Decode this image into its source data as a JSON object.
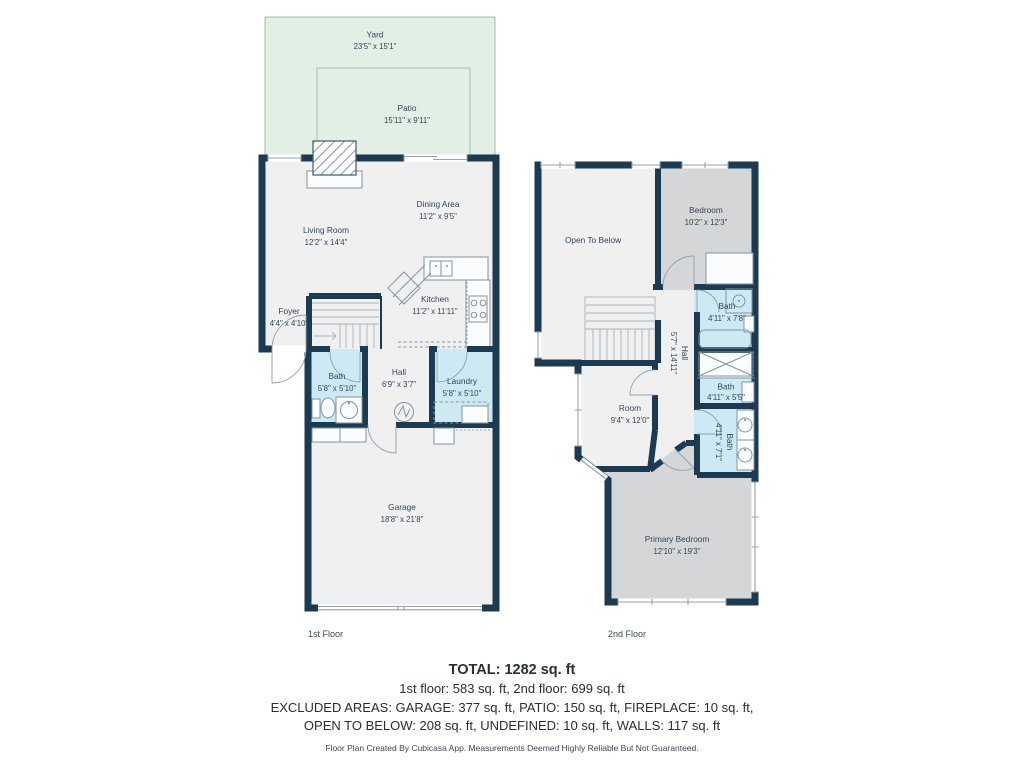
{
  "colors": {
    "wall": "#1c3a52",
    "floor": "#f0f0f1",
    "bedroom-fill": "#d5d6d7",
    "bath-fill": "#cde9f4",
    "yard-fill": "#e1efe5",
    "label-text": "#33465a",
    "summary-text": "#272e35",
    "fixture-line": "#8494a1"
  },
  "first_floor": {
    "label": "1st Floor",
    "yard": {
      "name": "Yard",
      "dims": "23'5\" x 15'1\""
    },
    "patio": {
      "name": "Patio",
      "dims": "15'11\" x 9'11\""
    },
    "living_room": {
      "name": "Living Room",
      "dims": "12'2\" x 14'4\""
    },
    "dining_area": {
      "name": "Dining Area",
      "dims": "11'2\" x 9'5\""
    },
    "kitchen": {
      "name": "Kitchen",
      "dims": "11'2\" x 11'11\""
    },
    "foyer": {
      "name": "Foyer",
      "dims": "4'4\" x 4'10\""
    },
    "bath": {
      "name": "Bath",
      "dims": "5'8\" x 5'10\""
    },
    "hall": {
      "name": "Hall",
      "dims": "6'9\" x 3'7\""
    },
    "laundry": {
      "name": "Laundry",
      "dims": "5'8\" x 5'10\""
    },
    "garage": {
      "name": "Garage",
      "dims": "18'8\" x 21'8\""
    }
  },
  "second_floor": {
    "label": "2nd Floor",
    "open_to_below": {
      "name": "Open To Below"
    },
    "bedroom": {
      "name": "Bedroom",
      "dims": "10'2\" x 12'3\""
    },
    "bath_top": {
      "name": "Bath",
      "dims": "4'11\" x 7'8\""
    },
    "hall": {
      "name": "Hall",
      "dims": "5'7\" x 14'11\""
    },
    "bath_mid": {
      "name": "Bath",
      "dims": "4'11\" x 5'5\""
    },
    "bath_lower": {
      "name": "Bath",
      "dims": "4'11\" x 7'1\""
    },
    "room": {
      "name": "Room",
      "dims": "9'4\" x 12'0\""
    },
    "primary_bedroom": {
      "name": "Primary Bedroom",
      "dims": "12'10\" x 19'3\""
    }
  },
  "summary": {
    "total": "TOTAL: 1282 sq. ft",
    "floors": "1st floor: 583 sq. ft, 2nd floor: 699 sq. ft",
    "excluded_line1": "EXCLUDED AREAS: GARAGE: 377 sq. ft, PATIO: 150 sq. ft, FIREPLACE: 10 sq. ft,",
    "excluded_line2": "OPEN TO BELOW: 208 sq. ft, UNDEFINED: 10 sq. ft, WALLS: 117 sq. ft",
    "disclaimer": "Floor Plan Created By Cubicasa App. Measurements Deemed Highly Reliable But Not Guaranteed."
  }
}
